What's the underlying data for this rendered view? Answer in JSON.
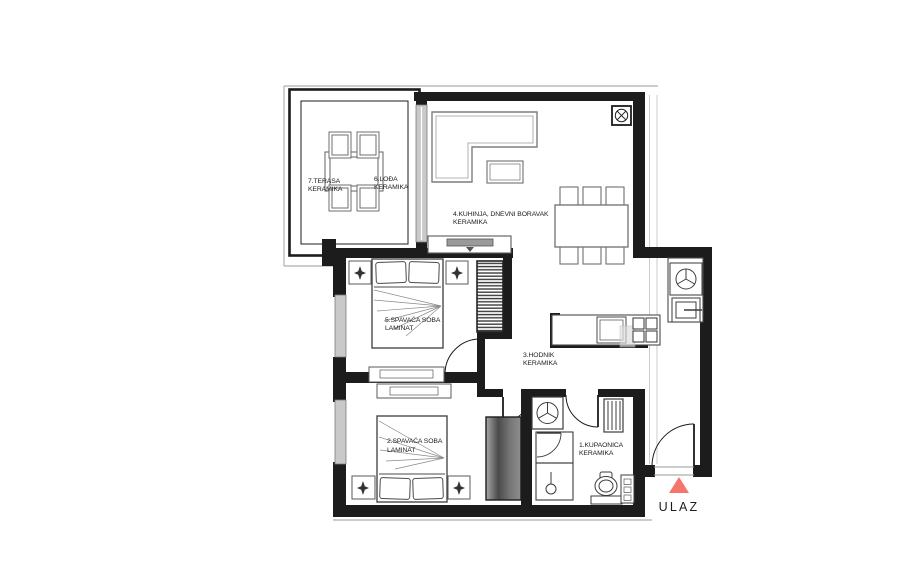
{
  "page": {
    "width": 918,
    "height": 562,
    "background": "#ffffff"
  },
  "floor_plan": {
    "type": "apartment-floor-plan",
    "rooms": [
      {
        "id": "kupaonica",
        "label": "1.KUPAONICA",
        "flooring": "KERAMIKA"
      },
      {
        "id": "spavaca-soba-2",
        "label": "2.SPAVAĆA SOBA",
        "flooring": "LAMINAT"
      },
      {
        "id": "hodnik",
        "label": "3.HODNIK",
        "flooring": "KERAMIKA"
      },
      {
        "id": "kuhinja-dnevni",
        "label": "4.KUHINJA, DNEVNI BORAVAK",
        "flooring": "KERAMIKA"
      },
      {
        "id": "spavaca-soba-5",
        "label": "5.SPAVAĆA SOBA",
        "flooring": "LAMINAT"
      },
      {
        "id": "lodja",
        "label": "6.LOĐA",
        "flooring": "KERAMIKA"
      },
      {
        "id": "terasa",
        "label": "7.TERASA",
        "flooring": "KERAMIKA"
      }
    ],
    "entrance": {
      "label": "ULAZ"
    },
    "colors": {
      "wall": "#1c1c1c",
      "furniture": "#6f6f6f",
      "window": "#c9c9c9",
      "accent": "#f4756b"
    }
  }
}
